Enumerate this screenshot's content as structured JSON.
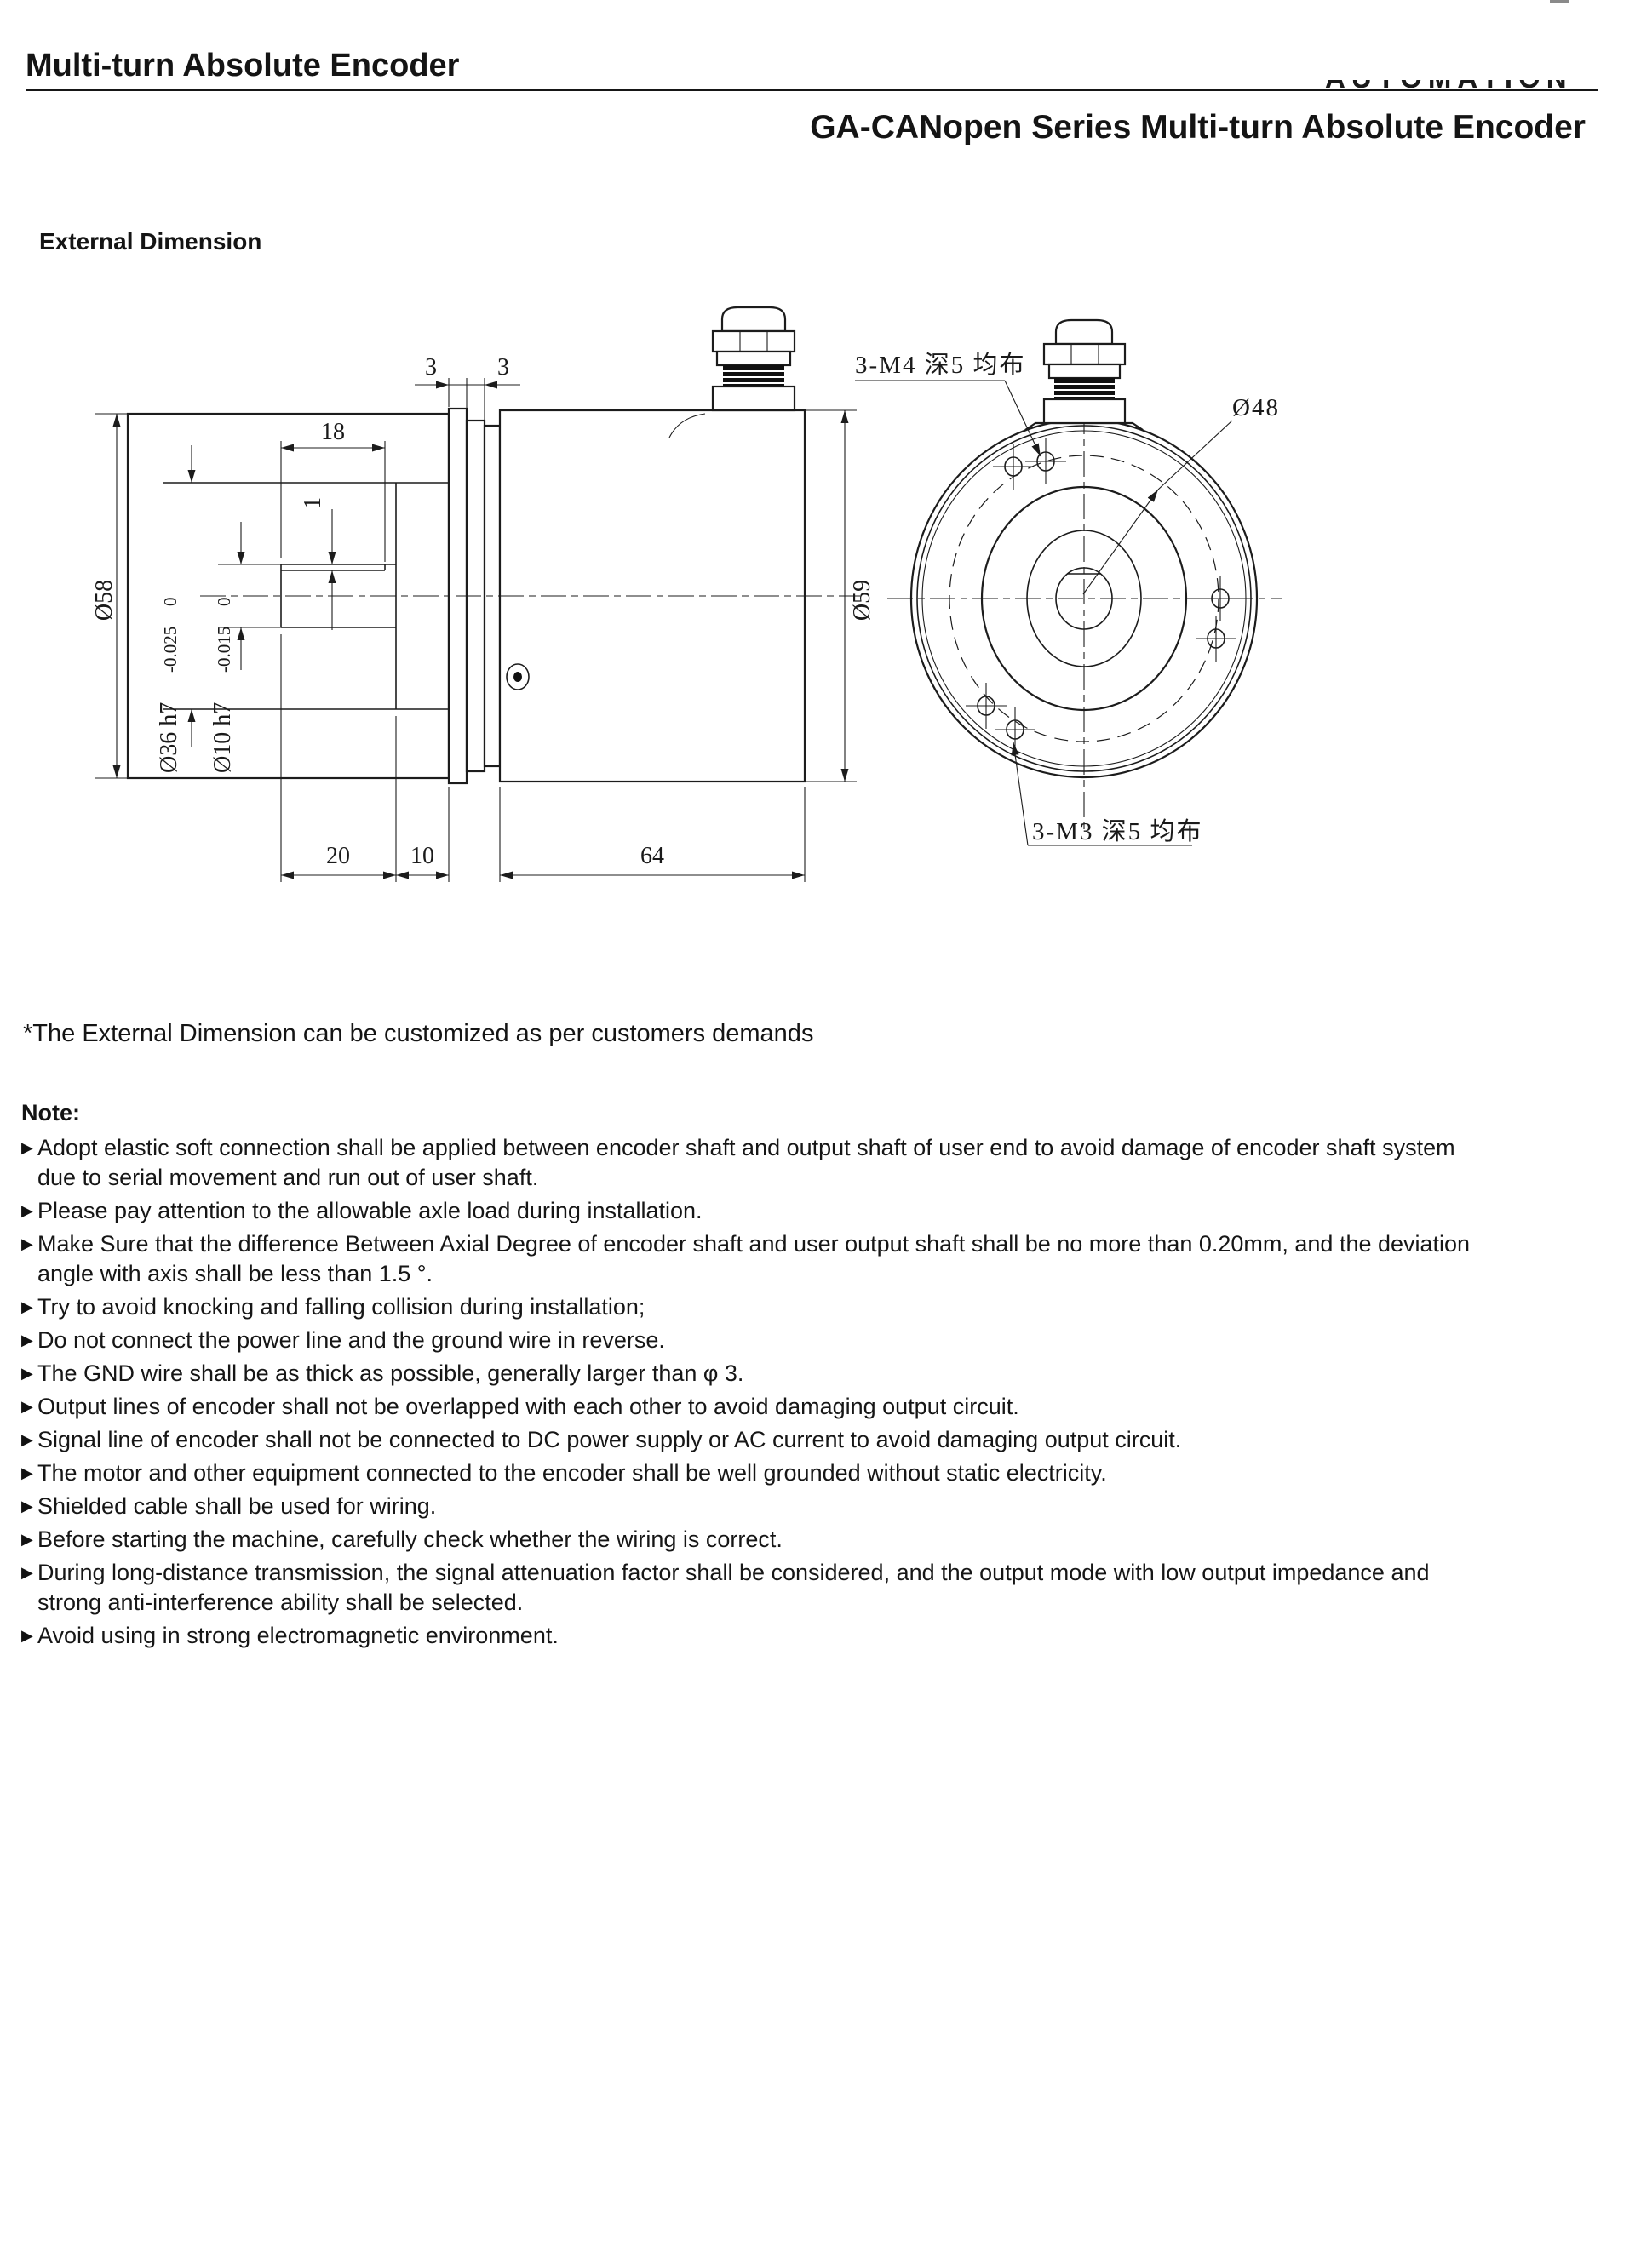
{
  "page": {
    "title": "Multi-turn Absolute Encoder",
    "brand_fragment": "AUTOMATION",
    "subtitle": "GA-CANopen Series Multi-turn Absolute Encoder",
    "section_heading": "External Dimension",
    "customize_note": "*The External Dimension can be customized as per customers demands"
  },
  "drawing": {
    "side_view": {
      "dim_flange_a": "3",
      "dim_flange_b": "3",
      "dim_flat_length": "18",
      "dim_flat_depth": "1",
      "dia_housing": "Ø58",
      "dia_boss": "Ø36 h7",
      "dia_boss_tol_upper": "0",
      "dia_boss_tol_lower": "-0.025",
      "dia_shaft": "Ø10 h7",
      "dia_shaft_tol_upper": "0",
      "dia_shaft_tol_lower": "-0.015",
      "dia_body": "Ø59",
      "dim_shaft_length": "20",
      "dim_boss_length": "10",
      "dim_body_length": "64"
    },
    "front_view": {
      "label_m4_holes": "3-M4 深5 均布",
      "label_bolt_circle": "Ø48",
      "label_m3_holes": "3-M3 深5 均布"
    }
  },
  "notes": {
    "heading": "Note:",
    "bullet_icon": "▶",
    "items": [
      {
        "lines": [
          "Adopt elastic soft connection shall be applied between encoder shaft and output shaft of user end to avoid damage of encoder shaft system",
          "due to serial movement and run out of user shaft."
        ]
      },
      {
        "lines": [
          "Please pay attention to the allowable axle load during installation."
        ]
      },
      {
        "lines": [
          "Make Sure that the difference Between Axial Degree of encoder shaft and user output shaft shall be no more than 0.20mm, and the deviation",
          "angle with axis shall be less than 1.5 °."
        ]
      },
      {
        "lines": [
          "Try to avoid knocking and falling collision during installation;"
        ]
      },
      {
        "lines": [
          "Do not connect the power line and the ground wire in reverse."
        ]
      },
      {
        "lines": [
          "The GND wire shall be as thick as possible, generally larger than φ 3."
        ]
      },
      {
        "lines": [
          "Output lines of encoder shall not be overlapped with each other to avoid damaging output circuit."
        ]
      },
      {
        "lines": [
          "Signal line of encoder shall not be connected to DC power supply or AC current to avoid damaging output circuit."
        ]
      },
      {
        "lines": [
          "The motor and other equipment connected to the encoder shall be well grounded without static electricity."
        ]
      },
      {
        "lines": [
          "Shielded cable shall be used for wiring."
        ]
      },
      {
        "lines": [
          "Before starting the machine, carefully check whether the wiring is correct."
        ]
      },
      {
        "lines": [
          "During long-distance transmission, the signal attenuation factor shall be considered, and the output mode with low output impedance and",
          "strong anti-interference ability shall be selected."
        ]
      },
      {
        "lines": [
          "Avoid using in strong electromagnetic environment."
        ]
      }
    ]
  }
}
